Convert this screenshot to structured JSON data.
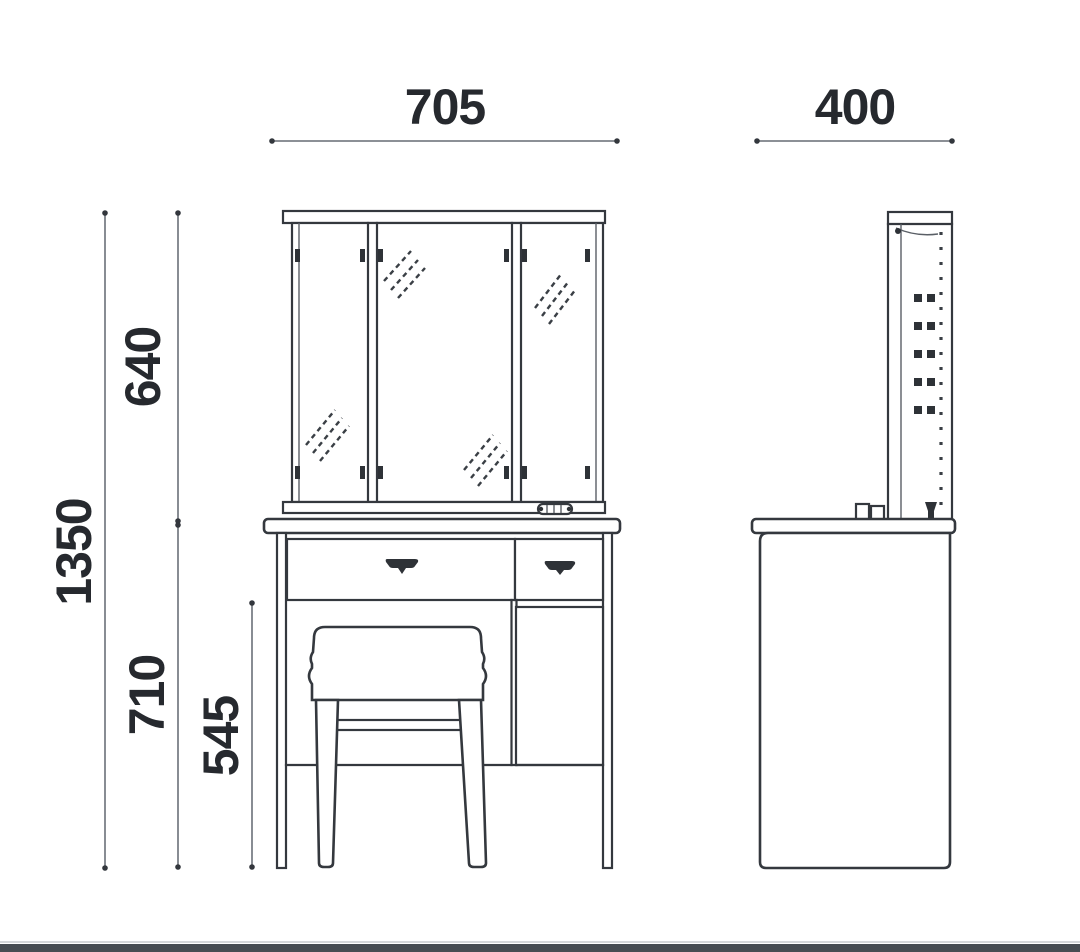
{
  "drawing": {
    "subject": "dressing-table-with-trifold-mirror-and-stool",
    "views": [
      "front-elevation",
      "side-elevation"
    ]
  },
  "dimensions": {
    "front_width": "705",
    "side_depth": "400",
    "mirror_height": "640",
    "overall_height": "1350",
    "table_height": "710",
    "knee_clearance": "545"
  },
  "colors": {
    "line_dark": "#34383e",
    "line_gray": "#7b8087",
    "text": "#26292e",
    "background": "#ffffff",
    "footer_bar": "#474c52"
  }
}
